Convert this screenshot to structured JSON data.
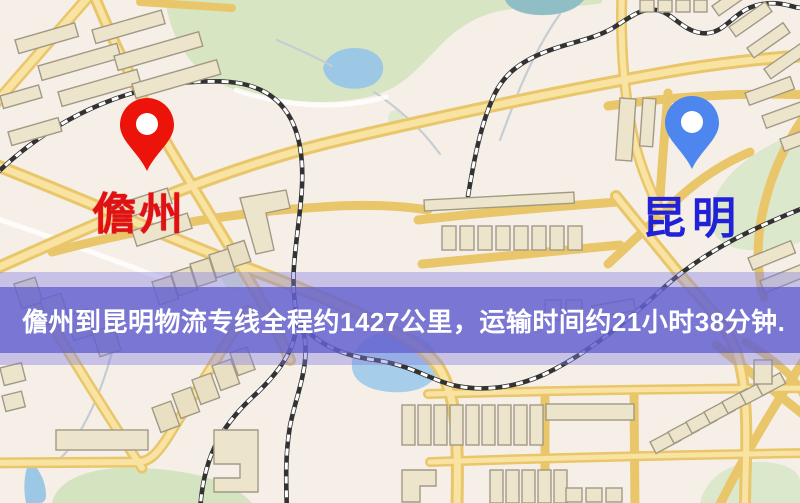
{
  "banner": {
    "text": "儋州到昆明物流专线全程约1427公里，运输时间约21小时38分钟.",
    "band_color": "#605DCE",
    "glow_color": "#807DE0",
    "text_color": "#FFFFFF"
  },
  "route": {
    "origin": "儋州",
    "destination": "昆明",
    "distance_text": "约1427公里",
    "duration_text": "约21小时38分钟"
  },
  "markers": {
    "origin": {
      "label": "儋州",
      "pin_color": "#EC130A",
      "label_color": "#E01112"
    },
    "destination": {
      "label": "昆明",
      "pin_color": "#4E86EF",
      "label_color": "#2121D8"
    }
  },
  "map_palette": {
    "background": "#F5EFE8",
    "road": "#EAC66A",
    "road_inner": "#F8E3A2",
    "park": "#D7E5C3",
    "water": "#9CC7E5",
    "building": "#EDE5CB",
    "railway": "#323232"
  }
}
